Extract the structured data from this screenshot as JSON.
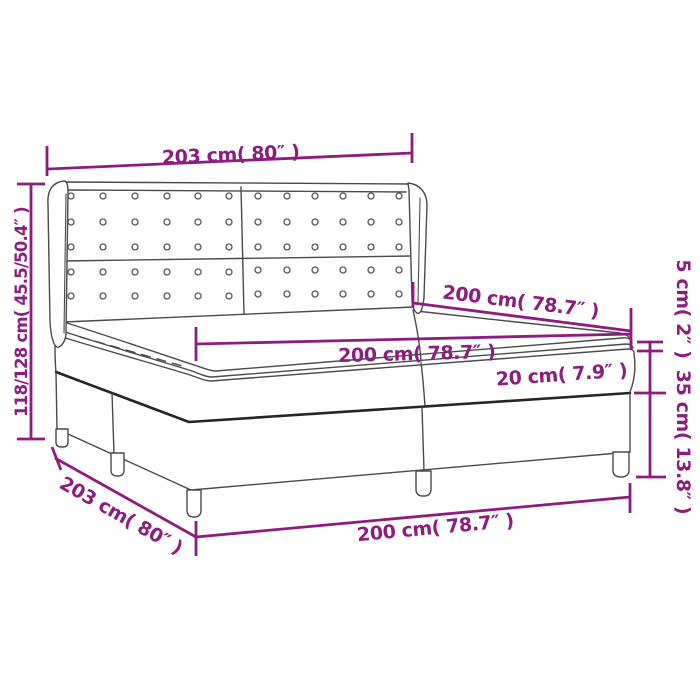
{
  "diagram": {
    "type": "product-dimension-line-drawing",
    "subject": "box spring bed with tufted wing headboard, two-piece mattress and topper",
    "style": {
      "dimension_color": "#8C1D7F",
      "line_color": "#4a4a4a",
      "edge_color": "#252525",
      "background": "#ffffff"
    },
    "labels": {
      "headboard_width": "203 cm( 80″ )",
      "total_height": "118/128 cm( 45.5/50.4″ )",
      "bed_length": "200 cm( 78.7″ )",
      "mattress_width": "200 cm( 78.7″ )",
      "mattress_thickness": "20 cm( 7.9″ )",
      "topper_thickness": "5 cm( 2″ )",
      "base_height": "35 cm( 13.8″ )",
      "base_depth": "203 cm( 80″ )",
      "base_width": "200 cm( 78.7″ )"
    }
  }
}
